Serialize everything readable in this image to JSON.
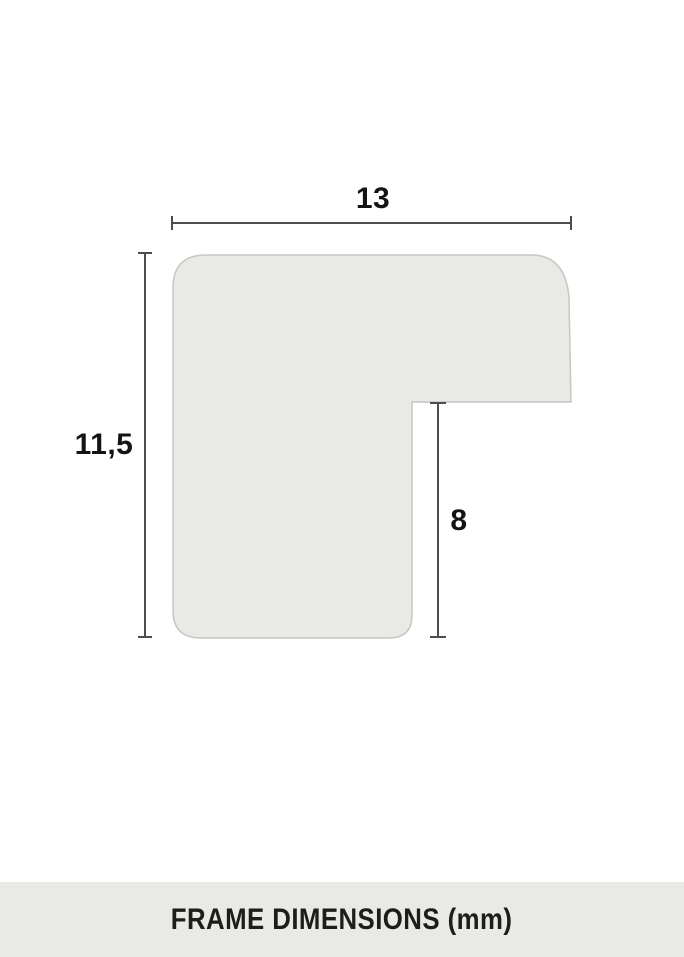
{
  "footer": {
    "label": "FRAME DIMENSIONS (mm)",
    "background": "#e9eae6",
    "text_color": "#1d1d1b"
  },
  "diagram": {
    "description": "Cross-section profile of a picture frame moulding with dimension annotations",
    "unit": "mm",
    "dimensions": [
      {
        "id": "width",
        "value": "13",
        "orientation": "horizontal",
        "position": "top"
      },
      {
        "id": "height",
        "value": "11,5",
        "orientation": "vertical",
        "position": "left"
      },
      {
        "id": "rabbet-depth",
        "value": "8",
        "orientation": "vertical",
        "position": "inner-notch"
      }
    ],
    "colors": {
      "background": "#ffffff",
      "shape_fill": "#e9eae6",
      "shape_stroke": "#c6c6c2",
      "dimension_line": "#4d4d4d",
      "label_text": "#141414"
    }
  }
}
